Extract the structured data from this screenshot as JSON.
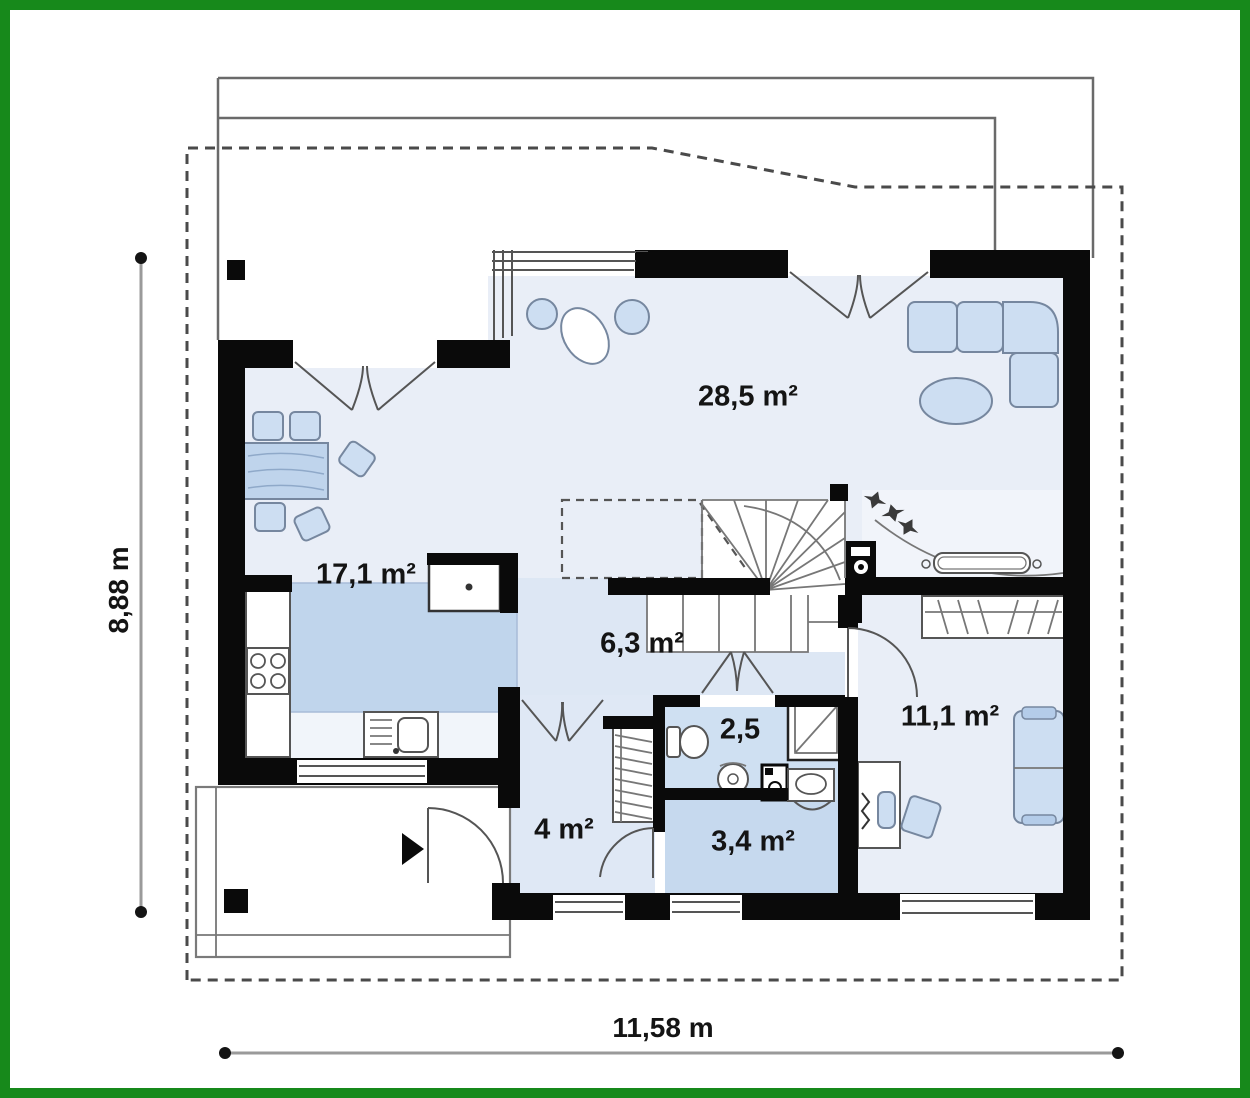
{
  "plan": {
    "type": "single-storey house floor plan",
    "rooms": [
      {
        "name": "living-room",
        "area": "28,5 m²"
      },
      {
        "name": "kitchen-dining",
        "area": "17,1 m²"
      },
      {
        "name": "hall",
        "area": "6,3 m²"
      },
      {
        "name": "wc",
        "area": "2,5"
      },
      {
        "name": "bathroom",
        "area": "3,4 m²"
      },
      {
        "name": "vestibule",
        "area": "4 m²"
      },
      {
        "name": "bedroom",
        "area": "11,1 m²"
      }
    ],
    "dimensions": {
      "height": "8,88 m",
      "width": "11,58 m"
    },
    "colors": {
      "frame": "#17891b",
      "wall": "#0a0a0a",
      "floor_light": "#e9eef7",
      "floor_medium": "#c6d9ee",
      "furniture_fill": "#cddef2",
      "furniture_outline": "#76879f",
      "roof_dashed": "#4a4a4a"
    },
    "elements": [
      "winder-staircase",
      "fireplace",
      "kitchen-island",
      "corner-sofa",
      "dining-table",
      "bed",
      "desk",
      "shower",
      "toilet",
      "washbasin",
      "washing-machine",
      "wardrobe",
      "boiler",
      "terrace",
      "entrance-porch"
    ]
  }
}
